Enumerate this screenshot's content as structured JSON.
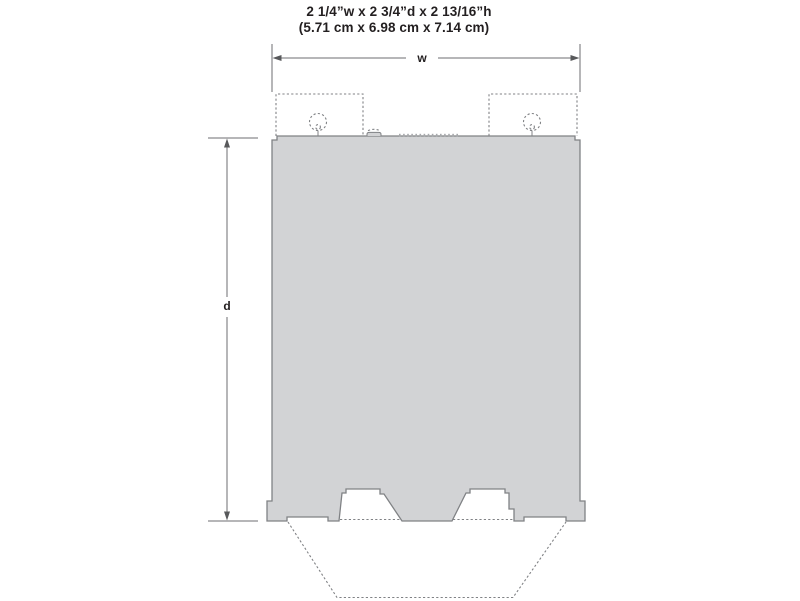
{
  "diagram": {
    "kind": "product-footprint-dimension-diagram",
    "title_line1": "2 1/4”w x 2 3/4”d x 2 13/16”h",
    "title_line2": "(5.71 cm x 6.98 cm x 7.14 cm)",
    "width_label": "w",
    "depth_label": "d",
    "vent_tick_count": 15,
    "colors": {
      "background": "#ffffff",
      "footprint_fill": "#d2d3d5",
      "outline": "#808285",
      "dimension_line": "#6d6e70",
      "hidden_line": "#808285",
      "text": "#231f20"
    }
  }
}
